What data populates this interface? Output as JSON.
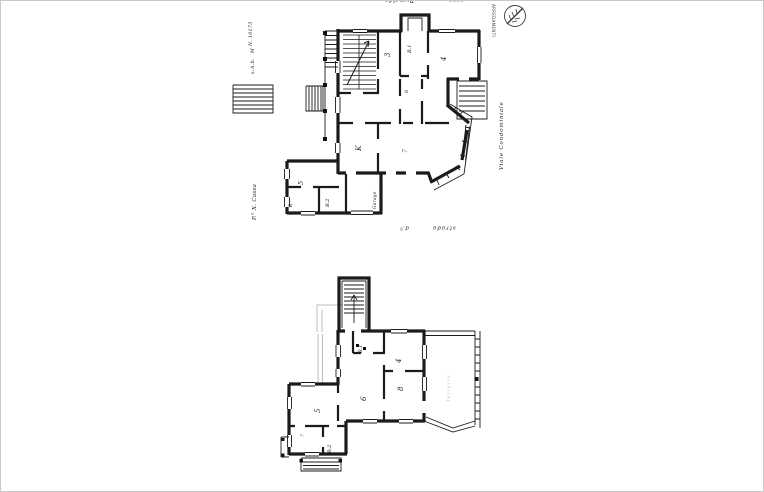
{
  "sheet": {
    "kind": "scanned architectural floor plan drawing, rotated 90 degrees on sheet",
    "paper_color": "#ffffff",
    "ink_color": "#1b1b1b",
    "faint_ink_color": "#bdbdbd",
    "border_color": "#c9c9c9"
  },
  "stamp": {
    "text": "ARREDAMENTI",
    "emblem": "feather-in-circle architect stamp"
  },
  "annotations": {
    "top_left": "Rumalda",
    "top_right": "casa",
    "side_note_no": "N. 10173",
    "side_note_m": "M",
    "side_note_scale": "s.A.b.",
    "owner": "P.° X. Cassa",
    "street_right": "Viale Condominiale",
    "bottom_small": "d.ª",
    "bottom_street": "strada",
    "terrace": "Terrazza",
    "garage": "Garage"
  },
  "plans": {
    "upper": {
      "name": "upper floor plan (with garage, stair, angled bay window)",
      "rooms": [
        {
          "label": "3"
        },
        {
          "label": "B.1"
        },
        {
          "label": "4"
        },
        {
          "label": "6"
        },
        {
          "label": "K"
        },
        {
          "label": "7"
        },
        {
          "label": "5"
        },
        {
          "label": "B.2"
        },
        {
          "label": "B"
        }
      ]
    },
    "lower": {
      "name": "lower floor plan (with stair tower and large terrace)",
      "rooms": [
        {
          "label": "B.1"
        },
        {
          "label": "4"
        },
        {
          "label": "8"
        },
        {
          "label": "6"
        },
        {
          "label": "5"
        },
        {
          "label": "B.2"
        },
        {
          "label": "7"
        }
      ]
    }
  }
}
